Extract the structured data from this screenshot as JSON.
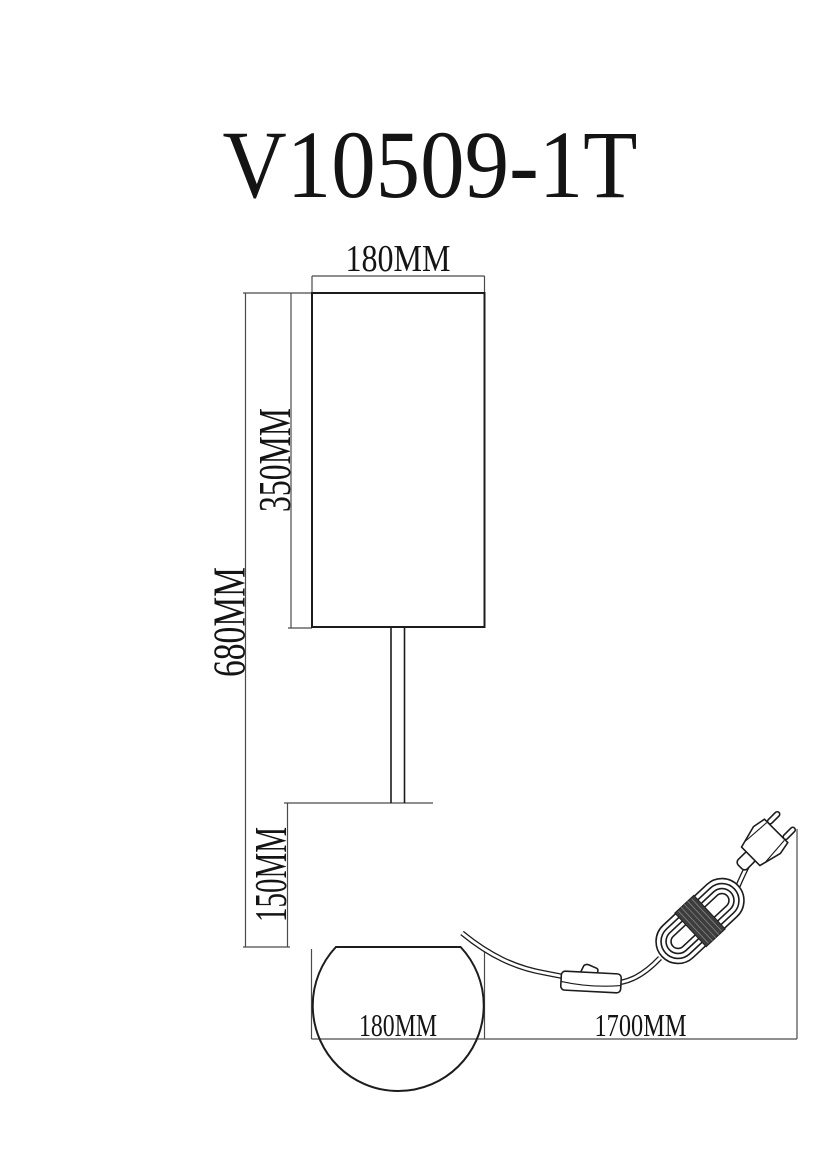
{
  "title": "V10509-1T",
  "drawing_type": "table-lamp dimension diagram",
  "dimensions": {
    "shade_width": "180MM",
    "shade_height": "350MM",
    "total_height": "680MM",
    "base_height": "150MM",
    "base_width": "180MM",
    "cord_length": "1700MM"
  },
  "colors": {
    "background": "#ffffff",
    "drawing_line": "#1c1c1c",
    "dimension_line": "#4a4a4a",
    "coil_band": "#3d3d3d"
  }
}
